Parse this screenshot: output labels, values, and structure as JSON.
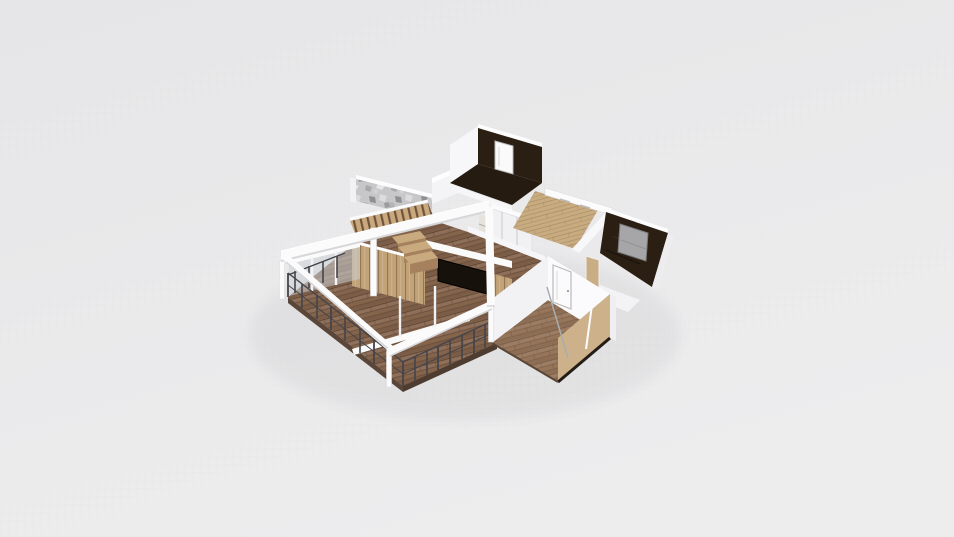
{
  "viewport": {
    "label": "3D floor plan view",
    "tool_hint": "orbitable 3D home design scene"
  },
  "scene": {
    "rooms": [
      {
        "name": "balcony-terrace",
        "floor": "wood deck",
        "features": [
          "white pergola frame",
          "metal wire railing"
        ]
      },
      {
        "name": "living-room",
        "floor": "wood planks",
        "features": [
          "glass window wall",
          "sliding door track",
          "wood wardrobe wall",
          "dark tv niche"
        ]
      },
      {
        "name": "staircase",
        "features": [
          "stone accent wall",
          "wood slat steps",
          "white stair rails"
        ]
      },
      {
        "name": "bathroom",
        "floor": "dark tile",
        "features": [
          "white interior door",
          "dark tiled wall"
        ]
      },
      {
        "name": "wardrobe-closet",
        "features": [
          "white sliding doors",
          "open shelves"
        ]
      },
      {
        "name": "hallway",
        "floor": "light wood",
        "features": [
          "white wall shelf"
        ]
      },
      {
        "name": "media-bedroom",
        "floor": "dark wood",
        "features": [
          "gray tv panel",
          "dark accent wall"
        ]
      },
      {
        "name": "lower-bedroom",
        "floor": "wood planks",
        "features": [
          "white door",
          "tan inner wall",
          "glass partition"
        ]
      }
    ],
    "colors": {
      "background_top": "#e6e6e8",
      "background_bottom": "#ededee",
      "grid_line": "#c9c9ce",
      "wall_white": "#f7f7f9",
      "wall_shaded": "#efeff1",
      "wall_cap": "#fdfdfe",
      "beam_white": "#fbfbfc",
      "beam_shadow": "#d7d7da",
      "wood_floor": "#96755a",
      "deck_wood": "#85644c",
      "light_wood": "#c9ab80",
      "dark_floor": "#261b11",
      "dark_wall": "#2b1f14",
      "tan_wall": "#ccb18b",
      "cabinet_wood": "#c2a277",
      "tv_gray": "#a6a6a8",
      "tv_niche": "#17110b",
      "railing_dark": "#44444a",
      "stone_wall": "#c7c7c9",
      "glass_tint": "#ccd2d6"
    }
  }
}
